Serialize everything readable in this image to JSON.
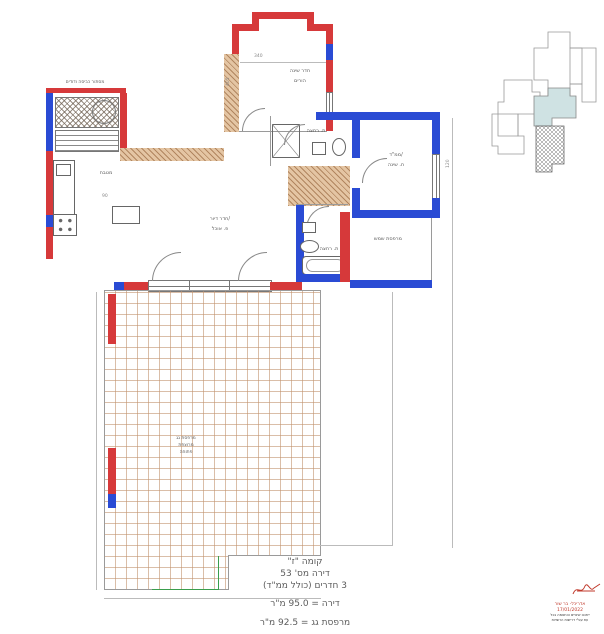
{
  "title_block": {
    "floor": "קומה \"ז\"",
    "apartment": "דירה מס' 53",
    "rooms": "3 חדרים (כולל ממ\"ד)",
    "apartment_area": "דירה = 95.0 מ\"ר",
    "terrace_area": "מרפסת גג = 92.5 מ\"ר"
  },
  "rooms": {
    "bedroom": "חדר שינה",
    "bedroom2": "הורים",
    "laundry": "מסתור כביסה ודודים",
    "kitchen": "מטבח",
    "living_1": "חדר דיור/",
    "living_2": "פ. אוכל",
    "bath_top": "ת. רחצה",
    "bath_bottom": "ת. רחצה",
    "mamad_1": "ממ\"ד/",
    "mamad_2": "ח. שינה",
    "sun_balcony": "מרפסת שמש",
    "terrace_1": "מרפסת גג",
    "terrace_2": "מרוצפת",
    "terrace_3": "פתוחה"
  },
  "dims": {
    "top": "340",
    "left": "405",
    "kitchen": "90",
    "mamad": "120"
  },
  "stamp": {
    "name": "אדריכל- בר שור",
    "date": "17/01/2022",
    "note_1": "ייתכנו שינויים והתאמה בכל",
    "note_2": "עת עפ\"י דרישות הרשויות"
  },
  "colors": {
    "wall_red": "#d6393a",
    "wall_blue": "#2a4bd4",
    "wall_tan": "#e4c5a3",
    "keyplan_highlight": "#cfe2e3",
    "terrace_grid": "#c1926e",
    "mark_green": "#3a9e4d"
  }
}
